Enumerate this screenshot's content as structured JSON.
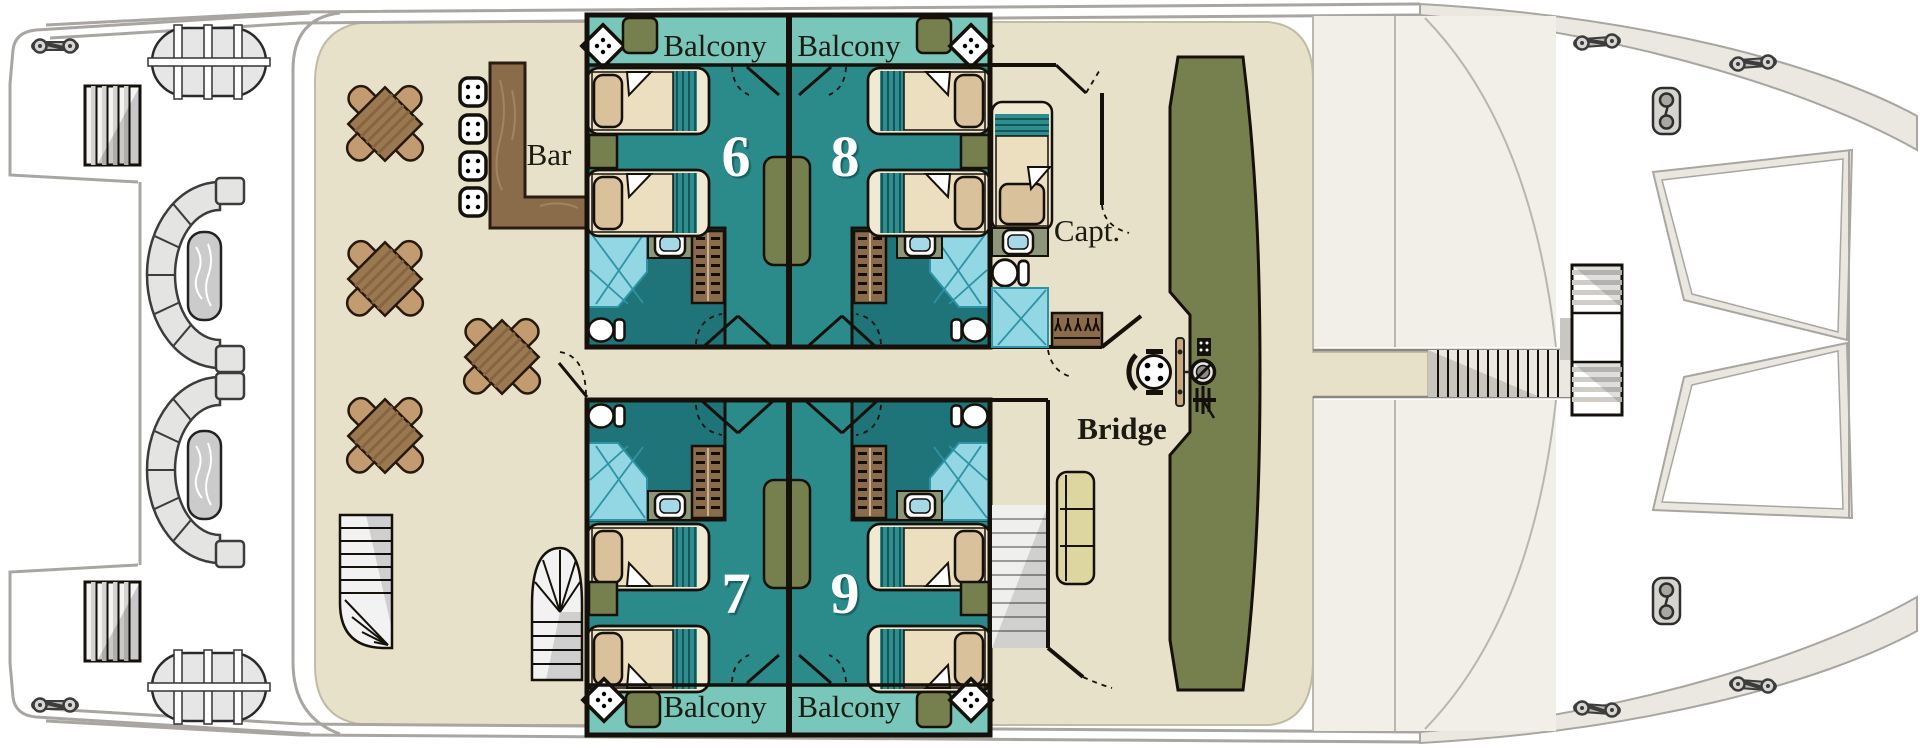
{
  "plan": {
    "labels": {
      "bar": "Bar",
      "captain": "Capt.",
      "bridge": "Bridge"
    },
    "cabins": [
      {
        "number": "6"
      },
      {
        "number": "8"
      },
      {
        "number": "7"
      },
      {
        "number": "9"
      }
    ],
    "balconies": [
      {
        "label": "Balcony"
      },
      {
        "label": "Balcony"
      },
      {
        "label": "Balcony"
      },
      {
        "label": "Balcony"
      }
    ],
    "colors": {
      "deck": "#e7e1c9",
      "cabin_floor": "#2b8b8b",
      "balcony_floor": "#79c6ba",
      "bathroom_floor": "#1e7478",
      "shower": "#92d7e3",
      "wood": "#8a6b4a",
      "table_wood": "#9a7850",
      "chair": "#c29b70",
      "olive_accent": "#76804e",
      "sofa": "#ddd6a0",
      "bed_frame": "#f1e9d2",
      "pillow": "#d8c19b",
      "wall": "#15100a",
      "hull_line": "#a9a6a1",
      "label_text": "#1b1b12",
      "cabin_number_text": "#ffffff"
    },
    "furniture_counts": {
      "dining_tables": 4,
      "dining_chairs": 16,
      "bar_stools": 4,
      "guest_beds": 8,
      "captain_beds": 1,
      "balcony_tables": 4,
      "balcony_side_tables": 4,
      "curved_lounge_benches": 2,
      "life_rafts": 2,
      "bridge_sofas": 1,
      "spiral_stairs": 2,
      "toilets": 5,
      "showers": 5,
      "wardrobes": 5
    }
  }
}
